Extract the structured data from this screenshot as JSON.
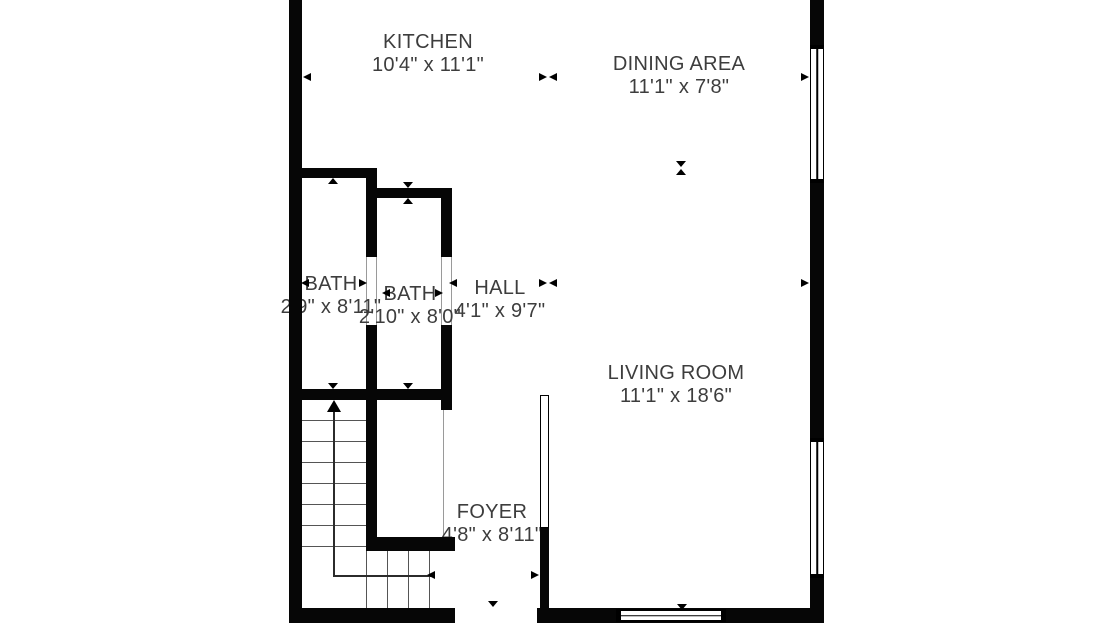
{
  "plan_title": "floor-plan",
  "colors": {
    "background": "#ffffff",
    "walls": "#060606",
    "room_text": "#3d3d3d",
    "stair_treads": "#555555",
    "door_jambs": "#9a9a9a"
  },
  "rooms": [
    {
      "id": "kitchen",
      "name": "KITCHEN",
      "dims": "10'4\" x 11'1\""
    },
    {
      "id": "dining",
      "name": "DINING AREA",
      "dims": "11'1\" x 7'8\""
    },
    {
      "id": "bath1",
      "name": "BATH",
      "dims": "2'9\" x 8'11\""
    },
    {
      "id": "bath2",
      "name": "BATH",
      "dims": "2'10\" x 8'0\""
    },
    {
      "id": "hall",
      "name": "HALL",
      "dims": "4'1\" x 9'7\""
    },
    {
      "id": "living",
      "name": "LIVING ROOM",
      "dims": "11'1\" x 18'6\""
    },
    {
      "id": "foyer",
      "name": "FOYER",
      "dims": "4'8\" x 8'11\""
    }
  ],
  "symbols": {
    "windows": 3,
    "interior_door_openings": 3,
    "stair_direction": "up",
    "dimension_markers": "paired black triangles"
  }
}
